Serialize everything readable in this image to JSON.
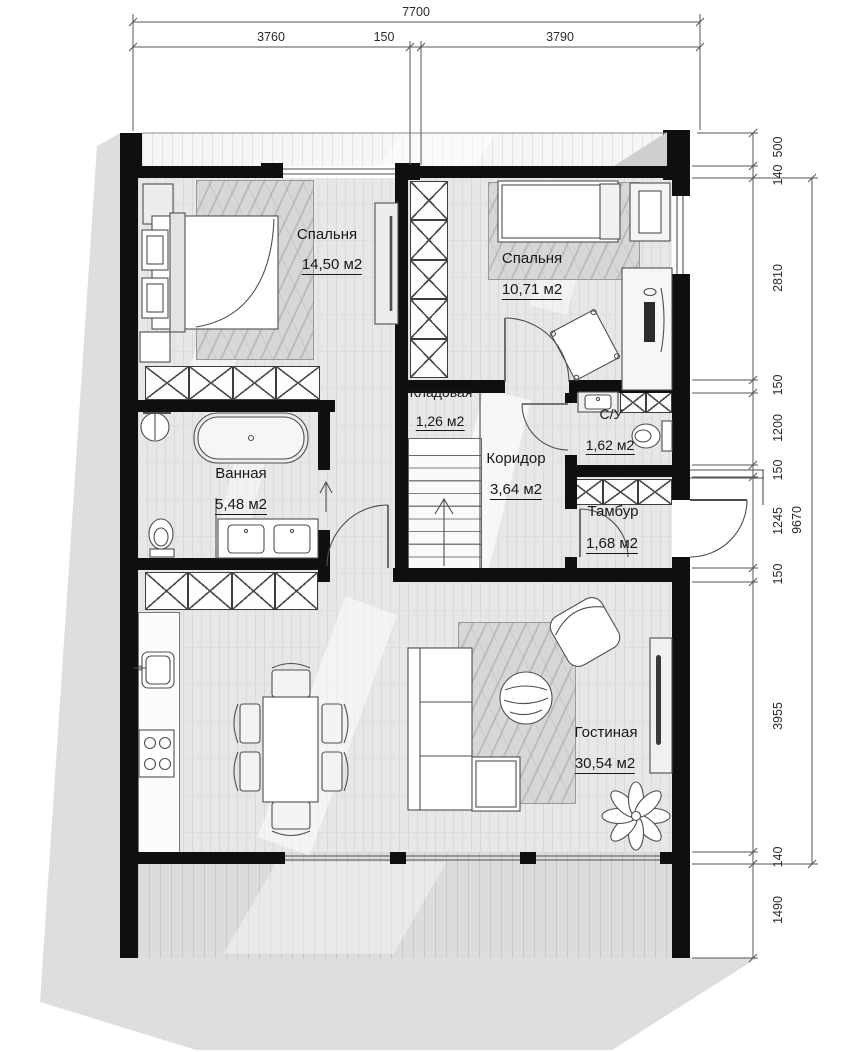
{
  "plan": {
    "rooms": [
      {
        "name": "Спальня",
        "area": "14,50 м2"
      },
      {
        "name": "Спальня",
        "area": "10,71 м2"
      },
      {
        "name": "Кладовая",
        "area": "1,26 м2"
      },
      {
        "name": "Коридор",
        "area": "3,64 м2"
      },
      {
        "name": "С/У",
        "area": "1,62 м2"
      },
      {
        "name": "Тамбур",
        "area": "1,68 м2"
      },
      {
        "name": "Ванная",
        "area": "5,48 м2"
      },
      {
        "name": "Гостиная",
        "area": "30,54 м2"
      }
    ],
    "dimensions": {
      "top": {
        "overall": "7700",
        "segments": [
          "3760",
          "150",
          "3790"
        ]
      },
      "right": {
        "overall": "9670",
        "segments": [
          "500",
          "140",
          "2810",
          "150",
          "1200",
          "150",
          "1245",
          "150",
          "3955",
          "140",
          "1490"
        ]
      }
    },
    "colors": {
      "wall": "#0f0f0f",
      "floor": "#e7e7e6",
      "shadow": "#dedede",
      "line": "#4f4f4f"
    }
  }
}
